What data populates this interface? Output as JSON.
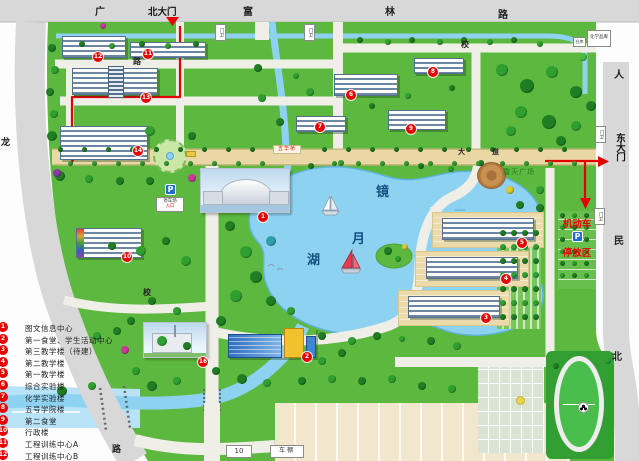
{
  "colors": {
    "lawn": "#5CB83E",
    "water": "#8ED2F2",
    "road_gray": "#D8D8D8",
    "avenue_tan": "#E9D7A6",
    "route_red": "#E60000"
  },
  "gates": {
    "north_label": "北大门",
    "east_label": "东大门",
    "guard_label": "门卫",
    "guard_posts": [
      {
        "x": 215,
        "y": 24
      },
      {
        "x": 304,
        "y": 24
      },
      {
        "x": 595,
        "y": 126
      },
      {
        "x": 594,
        "y": 208
      }
    ]
  },
  "road_chars": [
    {
      "t": "广",
      "x": 95,
      "y": 3,
      "s": 10
    },
    {
      "t": "富",
      "x": 243,
      "y": 3,
      "s": 10
    },
    {
      "t": "林",
      "x": 385,
      "y": 3,
      "s": 10
    },
    {
      "t": "路",
      "x": 498,
      "y": 6,
      "s": 10
    },
    {
      "t": "人",
      "x": 614,
      "y": 66,
      "s": 10
    },
    {
      "t": "民",
      "x": 614,
      "y": 232,
      "s": 10
    },
    {
      "t": "北",
      "x": 612,
      "y": 348,
      "s": 10
    },
    {
      "t": "龙",
      "x": 1,
      "y": 135,
      "s": 9
    },
    {
      "t": "路",
      "x": 112,
      "y": 442,
      "s": 9
    },
    {
      "t": "校",
      "x": 461,
      "y": 39,
      "s": 8
    },
    {
      "t": "路",
      "x": 133,
      "y": 56,
      "s": 8
    },
    {
      "t": "校",
      "x": 143,
      "y": 287,
      "s": 8
    },
    {
      "t": "大",
      "x": 458,
      "y": 147,
      "s": 7
    },
    {
      "t": "道",
      "x": 492,
      "y": 147,
      "s": 7
    }
  ],
  "lake_chars": [
    {
      "t": "镜",
      "x": 376,
      "y": 181
    },
    {
      "t": "月",
      "x": 352,
      "y": 228
    },
    {
      "t": "湖",
      "x": 307,
      "y": 249
    }
  ],
  "legend_items": [
    {
      "num": "1",
      "label": "图文信息中心"
    },
    {
      "num": "2",
      "label": "第一食堂、学生活动中心"
    },
    {
      "num": "3",
      "label": "第三教学楼（待建）"
    },
    {
      "num": "4",
      "label": "第二教学楼"
    },
    {
      "num": "5",
      "label": "第一教学楼"
    },
    {
      "num": "6",
      "label": "综合实验楼"
    },
    {
      "num": "7",
      "label": "化学实验楼"
    },
    {
      "num": "8",
      "label": "五号学院楼"
    },
    {
      "num": "9",
      "label": "第二食堂"
    },
    {
      "num": "10",
      "label": "行政楼"
    },
    {
      "num": "11",
      "label": "工程训练中心A"
    },
    {
      "num": "12",
      "label": "工程训练中心B"
    }
  ],
  "markers": [
    {
      "num": "1",
      "x": 263,
      "y": 217
    },
    {
      "num": "2",
      "x": 307,
      "y": 357
    },
    {
      "num": "3",
      "x": 486,
      "y": 318
    },
    {
      "num": "4",
      "x": 506,
      "y": 279
    },
    {
      "num": "5",
      "x": 522,
      "y": 243
    },
    {
      "num": "6",
      "x": 351,
      "y": 95
    },
    {
      "num": "7",
      "x": 320,
      "y": 127
    },
    {
      "num": "8",
      "x": 433,
      "y": 72
    },
    {
      "num": "9",
      "x": 411,
      "y": 129
    },
    {
      "num": "10",
      "x": 127,
      "y": 257
    },
    {
      "num": "11",
      "x": 148,
      "y": 54
    },
    {
      "num": "12",
      "x": 98,
      "y": 57
    },
    {
      "num": "13",
      "x": 146,
      "y": 98
    },
    {
      "num": "14",
      "x": 138,
      "y": 151
    },
    {
      "num": "16",
      "x": 203,
      "y": 362
    }
  ],
  "labels": {
    "plaza": "露天广场",
    "parking_line1": "机动车",
    "parking_line2": "停放区",
    "p": "P",
    "west_parking_line1": "停车场",
    "west_parking_line2": "入口",
    "bridge": "五华桥",
    "bike_shed": "车棚",
    "shed_no": "10",
    "store_small": "仓库",
    "store_big": "化学品库"
  }
}
